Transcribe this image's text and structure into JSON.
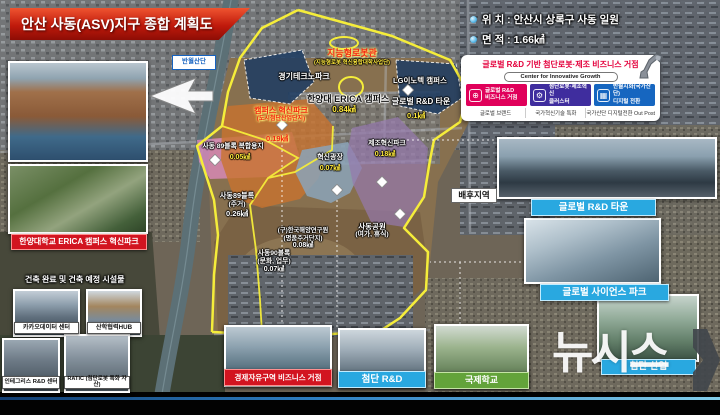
{
  "header": {
    "title": "안산 사동(ASV)지구 종합 계획도",
    "location": "위 치 : 안산시 상록구 사동 일원",
    "area": "면 적 : 1.66㎢"
  },
  "info_panel": {
    "title": "글로벌 R&D 기반 첨단로봇·제조 비즈니스 거점",
    "subtitle": "Center for Innovative Growth",
    "boxes": [
      {
        "line1": "글로벌 R&D",
        "line2": "비즈니스 거점",
        "caption": "글로벌 브랜드",
        "color": "#e0005a",
        "icon": "globe-icon"
      },
      {
        "line1": "첨단로봇·제조혁신",
        "line2": "클러스터",
        "caption": "국가혁신기술 특화",
        "color": "#3f2d9e",
        "icon": "robot-arm-icon"
      },
      {
        "line1": "반월시화(국가산단)",
        "line2": "디지털 전환",
        "caption": "국가산단 디지털전환 Out Post",
        "color": "#1666c0",
        "icon": "digital-grid-icon"
      }
    ]
  },
  "map_labels": {
    "banwol": "반월산단",
    "robot_hall_title": "지능형로봇관",
    "robot_hall_sub": "(지능형로봇 혁신융합대학사업단)",
    "gtp": "경기테크노파크",
    "lg": "LG이노텍 캠퍼스",
    "erica_name": "한양대 ERICA 캠퍼스",
    "erica_area": "0.84㎢",
    "rnd_town_name": "글로벌 R&D 타운",
    "rnd_town_area": "0.1㎢",
    "campus_park_name": "캠퍼스 혁신파크",
    "campus_park_sub": "(도시첨단산업단지)",
    "campus_park_area": "0.19㎢",
    "block89_mix_name": "사동 89블록 복합용지",
    "block89_mix_area": "0.05㎢",
    "block89_res_name": "사동89블록",
    "block89_res_sub": "(주거)",
    "block89_res_area": "0.26㎢",
    "plaza_name": "혁신광장",
    "plaza_area": "0.07㎢",
    "mfg_park_name": "제조혁신파크",
    "mfg_park_area": "0.18㎢",
    "kiost_name": "(구)한국해양연구원",
    "kiost_sub": "(명품주거단지)",
    "kiost_area": "0.08㎢",
    "block90_name": "사동90블록",
    "block90_sub": "(문화, 업무)",
    "block90_area": "0.07㎢",
    "park_name": "사동공원",
    "park_sub": "(여가, 휴식)",
    "hinterland": "배후지역"
  },
  "left_panel": {
    "erica_label": "한양대학교 ERICA 캠퍼스 혁신파크",
    "section_title": "건축 완료 및 건축 예정 시설물",
    "kakao_label": "카카오데이터 센터",
    "hub_label": "산학협력HUB"
  },
  "bottom_row": {
    "integris": "인테그리스 R&D 센터",
    "ratic": "RATIC (첨단로봇 특화 자산)",
    "freezone": "경제자유구역 비즈니스 거점",
    "rnd": "첨단 R&D",
    "school": "국제학교",
    "industry": "첨단 산업"
  },
  "right_panel": {
    "rnd_town": "글로벌 R&D 타운",
    "science_park": "글로벌 사이언스 파크"
  },
  "watermark": "뉴시스",
  "colors": {
    "accent_red": "#c8102e",
    "label_cyan": "#29a8e0",
    "label_green": "#63a33a",
    "boundary_yellow": "#f5ed3a",
    "box_magenta": "#e0005a",
    "box_purple": "#3f2d9e",
    "box_blue": "#1666c0"
  }
}
